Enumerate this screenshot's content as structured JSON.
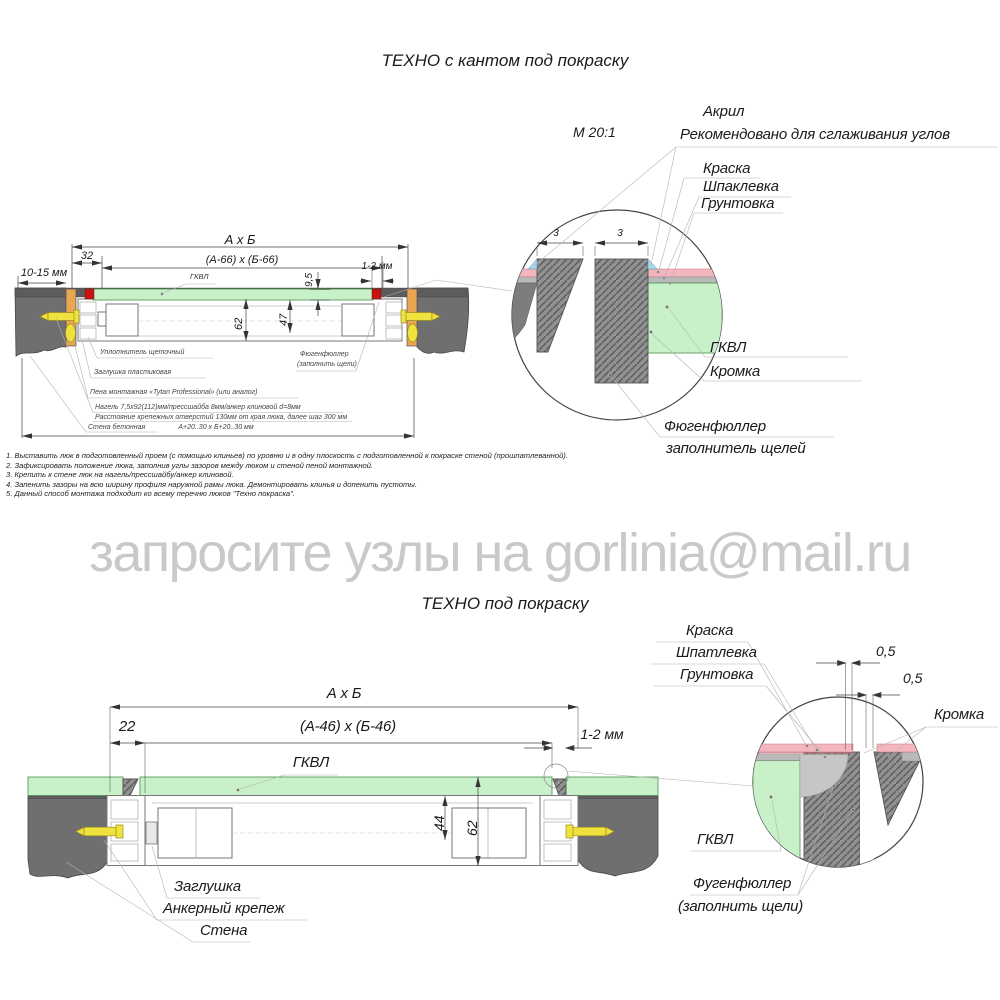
{
  "top": {
    "title": "ТЕХНО с кантом под покраску",
    "scale": "М 20:1",
    "dims": {
      "axb": "А х Б",
      "off": "32",
      "inner": "(А-66) х (Б-66)",
      "wall": "10-15 мм",
      "panel": "9,5",
      "gap": "1-2 мм",
      "depth": "62",
      "inner_depth": "47",
      "opening": "А+20..30 х Б+20..30 мм"
    },
    "gkvl": "ГКВЛ",
    "ann": {
      "seal": "Уплотнитель щеточный",
      "plug": "Заглушка пластиковая",
      "foam": "Пена монтажная «Tytan Professional» (или аналог)",
      "nagel": "Нагель 7,5х92(112)мм/прессшайба 8мм/анкер клиновой d=8мм",
      "spacing": "Расстояние крепежных отверстий 130мм от края люка, далее шаг 300 мм",
      "wall": "Стена бетонная",
      "filler1": "Фюгенфюллер",
      "filler2": "(заполнить щели)"
    },
    "detail": {
      "acryl": "Акрил",
      "acryl_note": "Рекомендовано для сглаживания углов",
      "paint": "Краска",
      "putty": "Шпаклевка",
      "primer": "Грунтовка",
      "d3a": "3",
      "d3b": "3",
      "gkvl": "ГКВЛ",
      "edge": "Кромка",
      "filler1": "Фюгенфюллер",
      "filler2": "заполнитель щелей"
    }
  },
  "instructions": [
    "1. Выставить люк в подготовленный проем (с помощью клиньев) по уровню и в одну плоскость с подготовленной к покраске стеной (прошпатлеванной).",
    "2. Зафиксировать положение люка, заполнив углы зазоров между люком и стеной пеной монтажной.",
    "3. Крепить к стене люк на нагель/прессшайбу/анкер клиновой.",
    "4. Запенить зазоры на всю ширину профиля наружной рамы люка. Демонтировать клинья и допенить пустоты.",
    "5. Данный способ монтажа подходит ко всему перечню люков \"Техно покраска\"."
  ],
  "watermark": "запросите узлы на gorlinia@mail.ru",
  "bottom": {
    "title": "ТЕХНО под покраску",
    "dims": {
      "axb": "А х Б",
      "off": "22",
      "inner": "(А-46) х (Б-46)",
      "gap": "1-2 мм",
      "inner_depth": "44",
      "depth": "62"
    },
    "gkvl": "ГКВЛ",
    "labels": {
      "plug": "Заглушка",
      "anchor": "Анкерный крепеж",
      "wall": "Стена"
    },
    "detail": {
      "paint": "Краска",
      "putty": "Шпатлевка",
      "primer": "Грунтовка",
      "d05a": "0,5",
      "d05b": "0,5",
      "edge": "Кромка",
      "gkvl": "ГКВЛ",
      "filler1": "Фугенфюллер",
      "filler2": "(заполнить щели)"
    }
  },
  "colors": {
    "wall": "#6f6f6f",
    "panel": "#c9f1c9",
    "wedge": "#e9a550",
    "anchor": "#efe23f",
    "marker": "#c41414",
    "paint": "#f3b6bf",
    "acryl": "#a5d8e8",
    "filler": "#c6c6c6",
    "watermark": "#c9c9c9"
  }
}
